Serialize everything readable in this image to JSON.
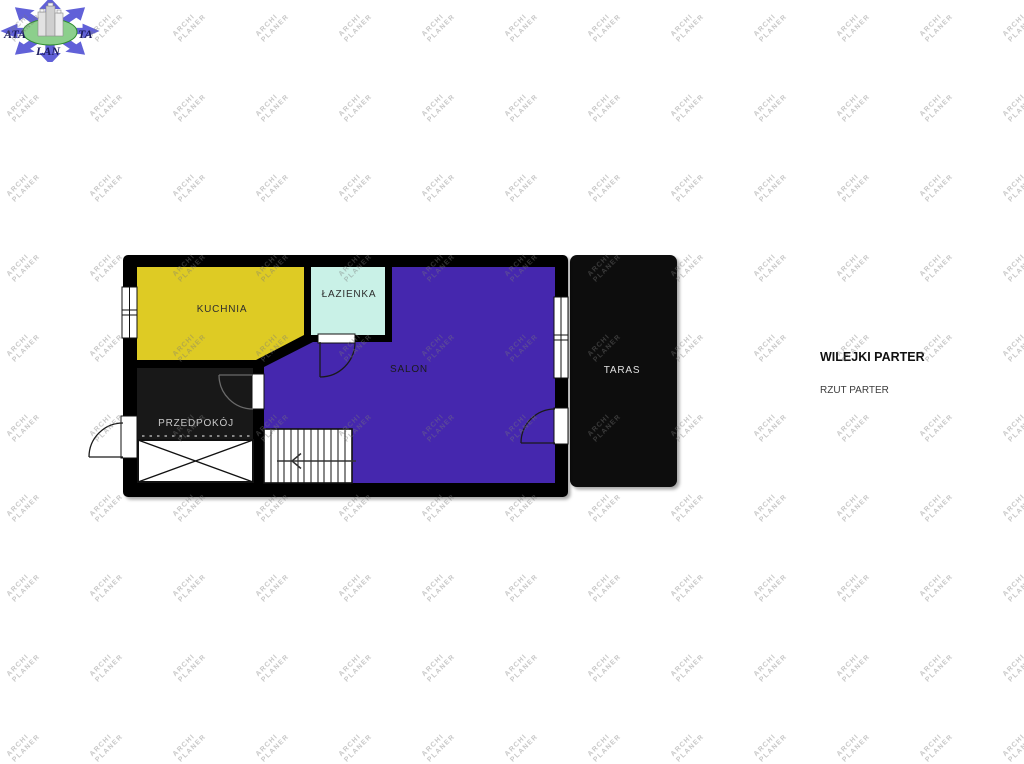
{
  "logo": {
    "text_left": "ATA",
    "text_right": "TA",
    "text_bottom": "LAN",
    "arrow_color": "#6161d8",
    "ellipse_color": "#8ccf8c",
    "text_color": "#1b1b5c"
  },
  "watermark": {
    "line1": "ARCHI",
    "line2": "PLANER"
  },
  "title_block": {
    "title": "WILEJKI PARTER",
    "subtitle": "RZUT PARTER"
  },
  "plan": {
    "wall_color": "#000000",
    "rooms": [
      {
        "id": "kuchnia",
        "label": "KUCHNIA",
        "color": "#decb24",
        "label_color": "#2e2e2e"
      },
      {
        "id": "lazienka",
        "label": "ŁAZIENKA",
        "color": "#c9f1e7",
        "label_color": "#2e2e2e"
      },
      {
        "id": "salon",
        "label": "SALON",
        "color": "#4527ae",
        "label_color": "#1b1b1b"
      },
      {
        "id": "przedpokoj",
        "label": "PRZEDPOKÓJ",
        "color": "#181818",
        "label_color": "#c9c9c9"
      },
      {
        "id": "taras",
        "label": "TARAS",
        "color": "#0a0a0a",
        "label_color": "#e0e0e0"
      }
    ]
  }
}
